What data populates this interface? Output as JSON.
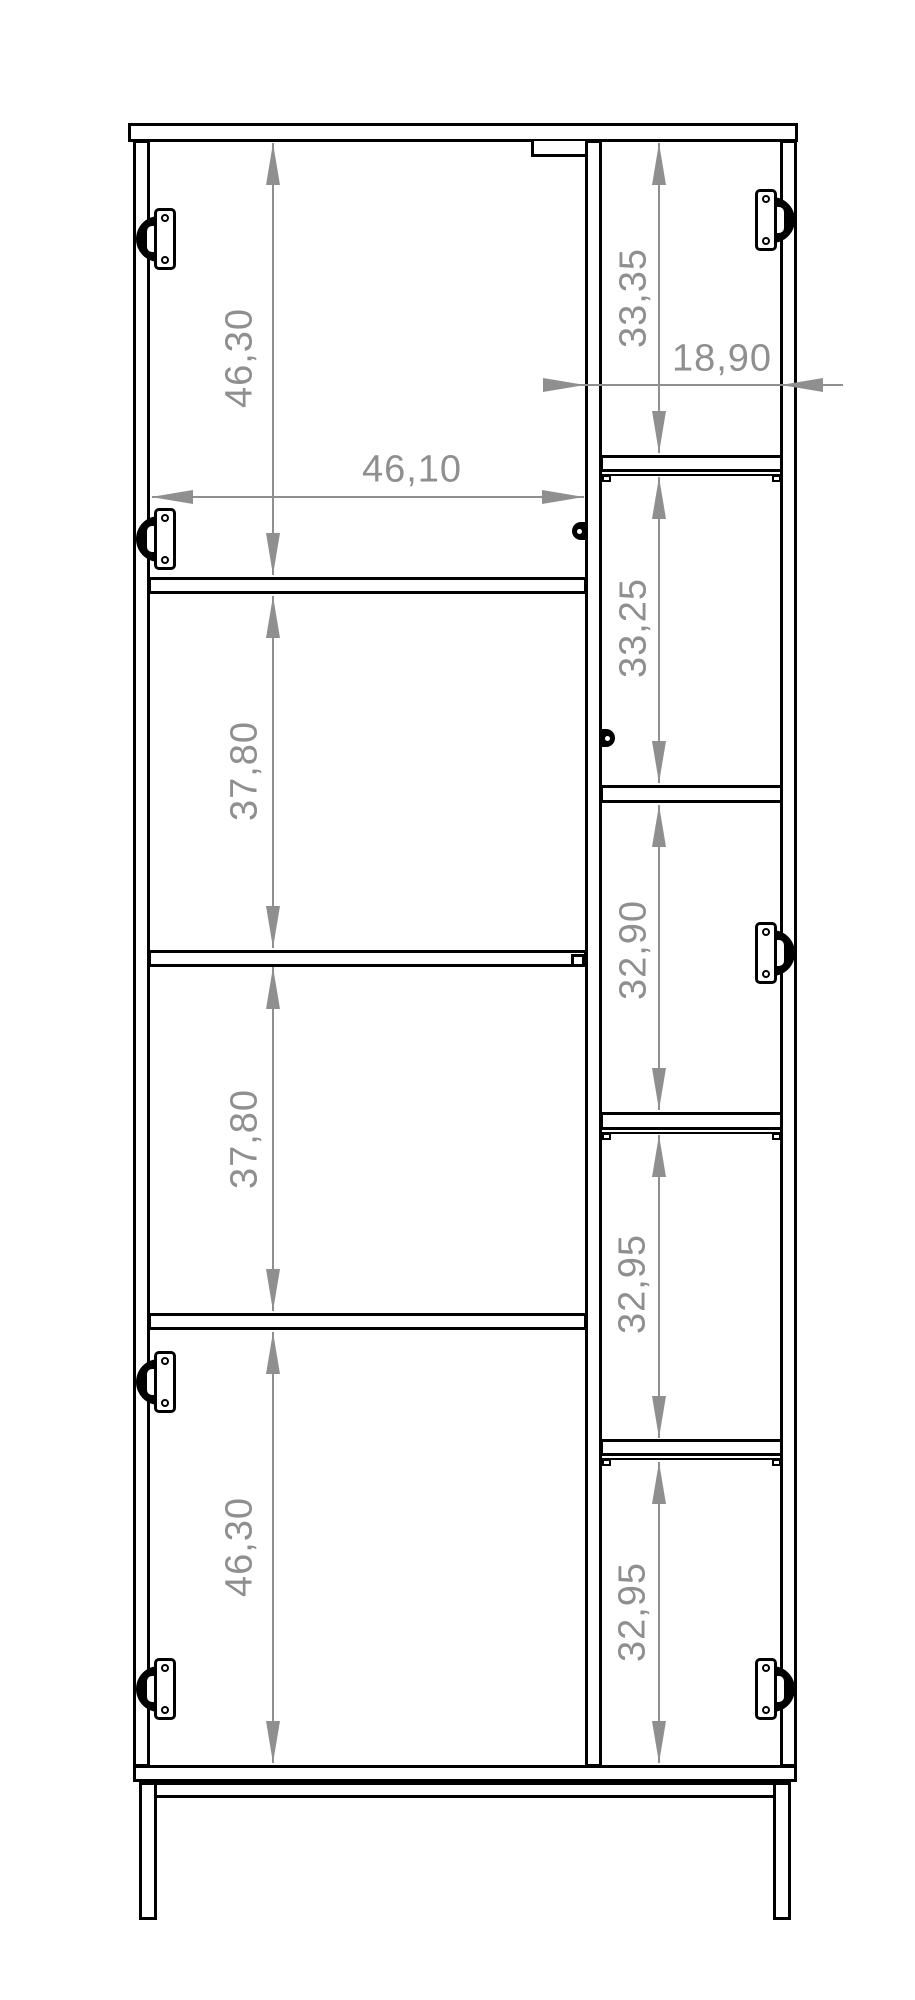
{
  "dims": {
    "left_sections": [
      {
        "value": "46,30"
      },
      {
        "value": "37,80"
      },
      {
        "value": "37,80"
      },
      {
        "value": "46,30"
      }
    ],
    "right_sections": [
      {
        "value": "33,35"
      },
      {
        "value": "33,25"
      },
      {
        "value": "32,90"
      },
      {
        "value": "32,95"
      },
      {
        "value": "32,95"
      }
    ],
    "left_width": {
      "value": "46,10"
    },
    "right_width": {
      "value": "18,90"
    }
  },
  "colors": {
    "outline": "#000000",
    "dimension": "#8f8f8f",
    "background": "#ffffff"
  }
}
